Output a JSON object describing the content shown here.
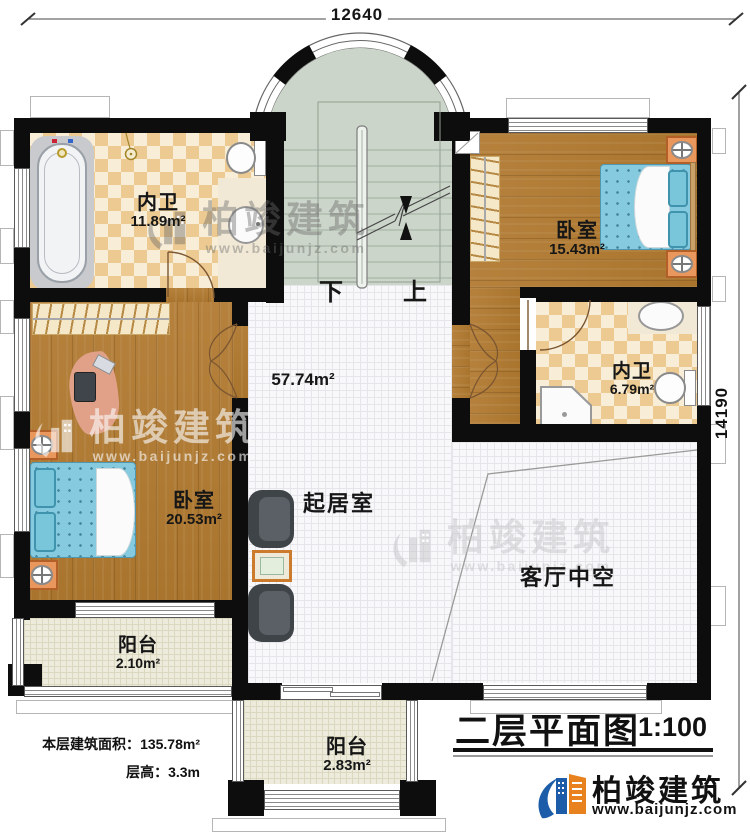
{
  "dimensions": {
    "top": "12640",
    "right": "14190"
  },
  "rooms": {
    "bath_top": {
      "name": "内卫",
      "area": "11.89m²"
    },
    "bedroom_right": {
      "name": "卧室",
      "area": "15.43m²"
    },
    "bath_right": {
      "name": "内卫",
      "area": "6.79m²"
    },
    "bedroom_left": {
      "name": "卧室",
      "area": "20.53m²"
    },
    "living": {
      "name": "起居室",
      "area": "57.74m²"
    },
    "void_space": {
      "name": "客厅中空"
    },
    "balcony_left": {
      "name": "阳台",
      "area": "2.10m²"
    },
    "balcony_bottom": {
      "name": "阳台",
      "area": "2.83m²"
    }
  },
  "stairs": {
    "down": "下",
    "up": "上"
  },
  "footer": {
    "area_label": "本层建筑面积：",
    "area_value": "135.78m²",
    "height_label": "层高：",
    "height_value": "3.3m"
  },
  "title_block": {
    "title": "二层平面图",
    "scale": "1:100"
  },
  "brand": {
    "name": "柏竣建筑",
    "website": "www.baijunjz.com"
  },
  "colors": {
    "wall": "#0d0d0d",
    "wood": "#b07a33",
    "tile_accent": "#ecca92",
    "stair_floor": "#cbd5c9",
    "bed_blue": "#85cade",
    "logo_blue": "#1c5ca8",
    "logo_orange": "#e8821e"
  }
}
